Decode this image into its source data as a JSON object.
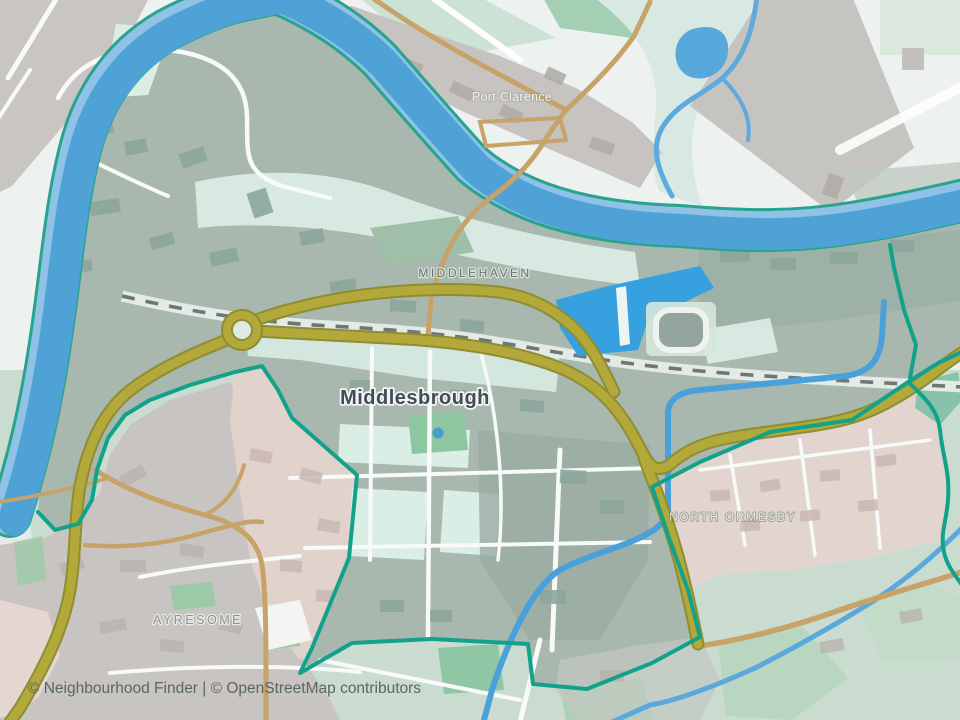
{
  "map": {
    "place_labels": {
      "port_clarence": "Port Clarence",
      "middlehaven": "MIDDLEHAVEN",
      "middlesbrough": "Middlesbrough",
      "north_ormesby": "NORTH ORMESBY",
      "ayresome": "AYRESOME"
    },
    "attribution": "© Neighbourhood Finder | © OpenStreetMap contributors",
    "legend_colors": {
      "boundary_teal": "#12a28a",
      "river_blue": "#51a2d6",
      "river_light_blue": "#8fc2e6",
      "dock_blue": "#37a0de",
      "primary_road_olive": "#b2a93a",
      "secondary_road_tan": "#c7a269",
      "selected_area_green_grey": "#a8b8af",
      "adjacent_area_pink": "#e2d2cc",
      "railway_dash_grey": "#6d7874"
    }
  }
}
